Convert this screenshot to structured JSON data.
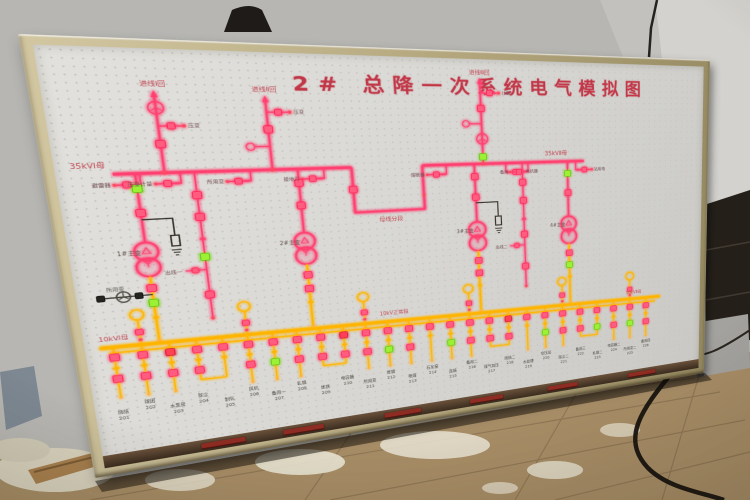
{
  "board": {
    "title": "2# 总降一次系统电气模拟图",
    "colors": {
      "line_hot": "#ff4070",
      "line_amber": "#ffb500",
      "led_pink": "#ff5b80",
      "led_green": "#9cf136",
      "led_red": "#ff4054",
      "label_red": "#c04552",
      "label_dark": "#6e4b50",
      "frame": "#b3a67f",
      "panel": "#d8d7d3"
    },
    "upper": {
      "bus_label_left": "35kVⅠ母",
      "bus_label_right": "35kVⅡ母",
      "tie_label": "母线分段",
      "incomings": [
        {
          "label": "进线Ⅰ回"
        },
        {
          "label": "进线Ⅱ回"
        },
        {
          "label": "进线Ⅲ回"
        }
      ],
      "stub_labels": [
        "避雷器",
        "压变",
        "计量",
        "熔断器",
        "接地刀",
        "电缆头"
      ],
      "branch_labels": [
        "避雷器",
        "压变计量",
        "所用变",
        "接地刀",
        "熔断器",
        "电抗器",
        "备用",
        "站用电",
        "出线一",
        "出线二"
      ]
    },
    "transformers": [
      {
        "label": "1#主变"
      },
      {
        "label": "2#主变"
      },
      {
        "label": "3#主变"
      },
      {
        "label": "4#主变"
      }
    ],
    "aux_label": "所用变",
    "lower": {
      "bus_label_left": "10kVⅠ母",
      "bus_label_mid": "10kV正常段",
      "bus_label_right": "10kVⅡ母",
      "feeders": [
        {
          "label": "烧结",
          "code": "201",
          "led1": "p",
          "led2": "p",
          "u": false,
          "j": false
        },
        {
          "label": "球团",
          "code": "202",
          "led1": "p",
          "led2": "p",
          "u": true,
          "j": false
        },
        {
          "label": "水泵房",
          "code": "203",
          "led1": "r",
          "led2": "p",
          "u": false,
          "j": false
        },
        {
          "label": "除尘",
          "code": "204",
          "led1": "p",
          "led2": "p",
          "u": false,
          "j": true
        },
        {
          "label": "制氧",
          "code": "205",
          "led1": "p",
          "led2": "",
          "u": false,
          "j": false
        },
        {
          "label": "风机",
          "code": "206",
          "led1": "p",
          "led2": "p",
          "u": true,
          "j": false
        },
        {
          "label": "备用一",
          "code": "207",
          "led1": "p",
          "led2": "g",
          "u": false,
          "j": false
        },
        {
          "label": "轧钢",
          "code": "208",
          "led1": "p",
          "led2": "p",
          "u": false,
          "j": false
        },
        {
          "label": "炼铁",
          "code": "209",
          "led1": "p",
          "led2": "p",
          "u": false,
          "j": true
        },
        {
          "label": "电容器",
          "code": "210",
          "led1": "r",
          "led2": "p",
          "u": false,
          "j": false
        },
        {
          "label": "所用变",
          "code": "211",
          "led1": "p",
          "led2": "p",
          "u": true,
          "j": false
        },
        {
          "label": "炼钢",
          "code": "212",
          "led1": "p",
          "led2": "g",
          "u": false,
          "j": false
        },
        {
          "label": "喷煤",
          "code": "213",
          "led1": "p",
          "led2": "p",
          "u": false,
          "j": false
        },
        {
          "label": "石灰窑",
          "code": "214",
          "led1": "p",
          "led2": "",
          "u": false,
          "j": false
        },
        {
          "label": "连铸",
          "code": "215",
          "led1": "p",
          "led2": "g",
          "u": false,
          "j": false
        },
        {
          "label": "备用二",
          "code": "216",
          "led1": "p",
          "led2": "p",
          "u": true,
          "j": false
        },
        {
          "label": "煤气加压",
          "code": "217",
          "led1": "p",
          "led2": "p",
          "u": false,
          "j": true
        },
        {
          "label": "烧结二",
          "code": "218",
          "led1": "r",
          "led2": "p",
          "u": false,
          "j": false
        },
        {
          "label": "水处理",
          "code": "219",
          "led1": "p",
          "led2": "",
          "u": false,
          "j": false
        },
        {
          "label": "空压站",
          "code": "220",
          "led1": "p",
          "led2": "g",
          "u": false,
          "j": false
        },
        {
          "label": "除尘二",
          "code": "221",
          "led1": "p",
          "led2": "p",
          "u": true,
          "j": false
        },
        {
          "label": "备用三",
          "code": "222",
          "led1": "p",
          "led2": "p",
          "u": false,
          "j": true
        },
        {
          "label": "轧钢二",
          "code": "223",
          "led1": "p",
          "led2": "g",
          "u": false,
          "j": false
        },
        {
          "label": "电容器二",
          "code": "224",
          "led1": "p",
          "led2": "p",
          "u": false,
          "j": false
        },
        {
          "label": "所用变二",
          "code": "225",
          "led1": "p",
          "led2": "g",
          "u": true,
          "j": false
        },
        {
          "label": "备用四",
          "code": "226",
          "led1": "p",
          "led2": "p",
          "u": false,
          "j": false
        }
      ]
    }
  }
}
